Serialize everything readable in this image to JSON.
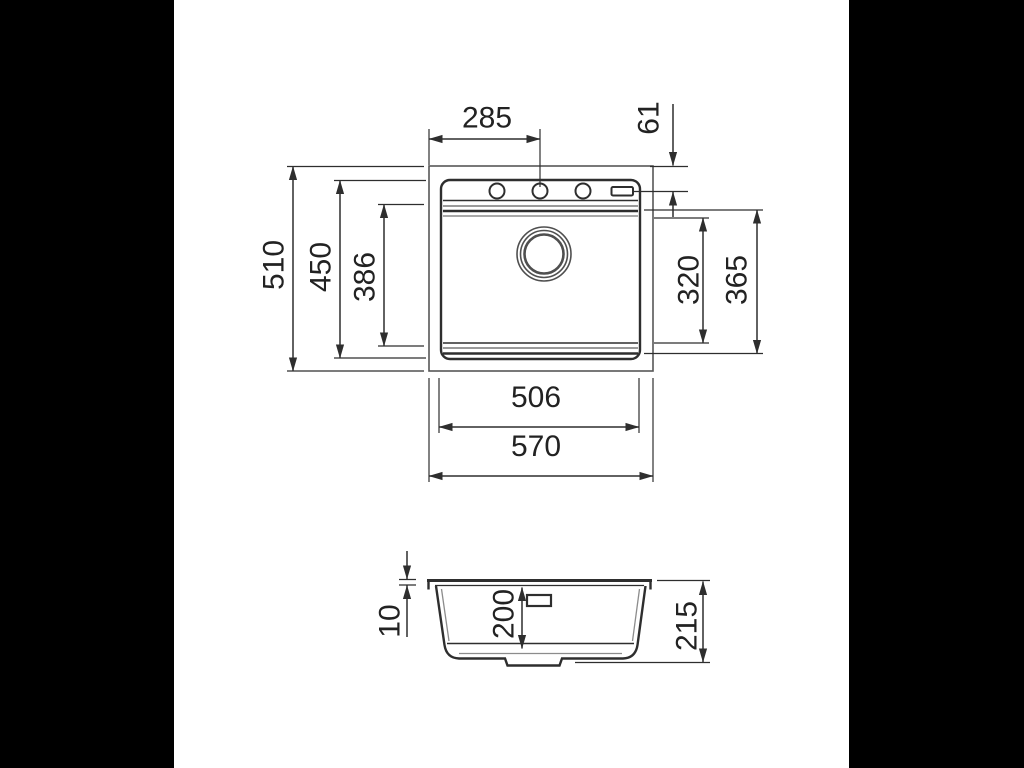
{
  "colors": {
    "background": "#000000",
    "paper": "#ffffff",
    "line_dark": "#2e2e2e",
    "line_gray": "#8c8c8c",
    "text": "#222222"
  },
  "top_view": {
    "dims": {
      "d285": "285",
      "d61": "61",
      "d510": "510",
      "d450": "450",
      "d386": "386",
      "d320": "320",
      "d365": "365",
      "d506": "506",
      "d570": "570"
    }
  },
  "side_view": {
    "dims": {
      "d10": "10",
      "d200": "200",
      "d215": "215"
    }
  }
}
